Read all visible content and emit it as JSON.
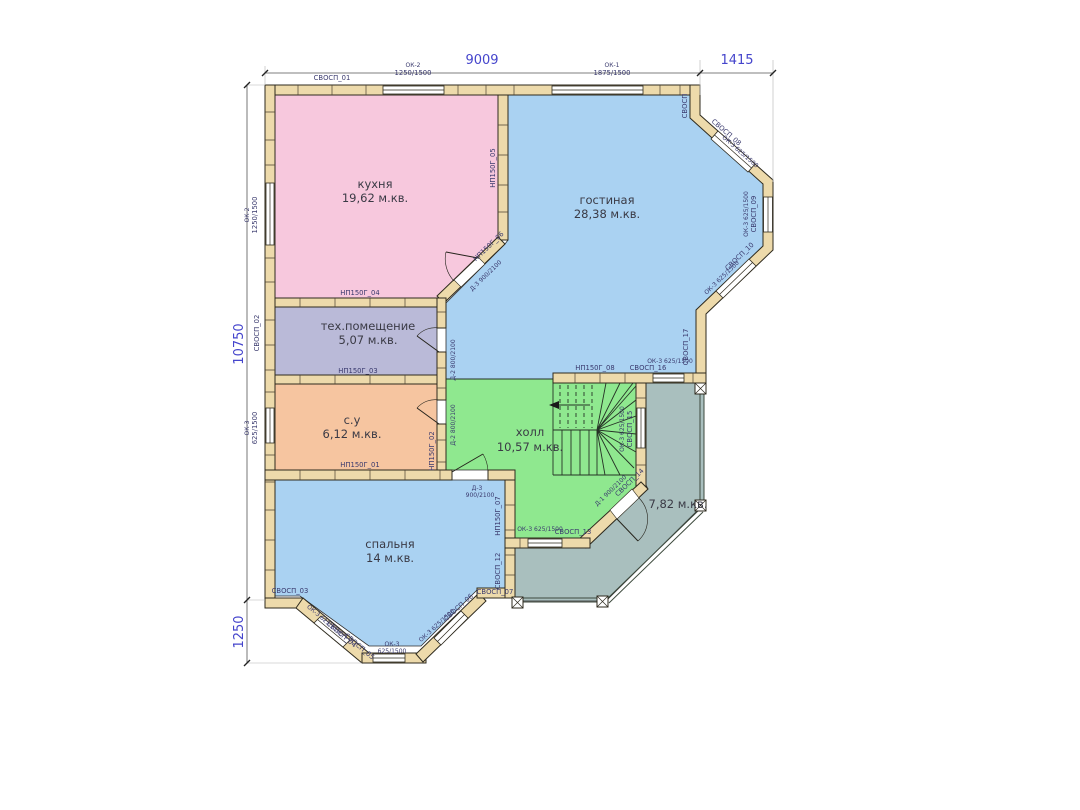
{
  "title": "План 1 этажа",
  "dimensions": {
    "top": "9009",
    "top_right": "1415",
    "left": "10750",
    "bottom_left": "1250"
  },
  "rooms": {
    "kitchen": {
      "name": "кухня",
      "area": "19,62 м.кв."
    },
    "living": {
      "name": "гостиная",
      "area": "28,38 м.кв."
    },
    "tech": {
      "name": "тех.помещение",
      "area": "5,07 м.кв."
    },
    "wc": {
      "name": "с.у",
      "area": "6,12 м.кв."
    },
    "hall": {
      "name": "холл",
      "area": "10,57 м.кв."
    },
    "bedroom": {
      "name": "спальня",
      "area": "14 м.кв."
    },
    "terrace": {
      "area": "7,82 м.кв."
    }
  },
  "panels": {
    "svosp01": "СВОСП_01",
    "svosp02": "СВОСП_02",
    "svosp03": "СВОСП_03",
    "svosp04": "СВОСП_04",
    "svosp05": "СВОСП_05",
    "svosp06": "СВОСП_06",
    "svosp07": "СВОСП_07",
    "svosp08": "СВОСП_08",
    "svosp09": "СВОСП_09",
    "svosp10": "СВОСП_10",
    "svosp12": "СВОСП_12",
    "svosp13": "СВОСП_13",
    "svosp14": "СВОСП_14",
    "svosp15": "СВОСП_15",
    "svosp16": "СВОСП_16",
    "svosp17": "СВОСП_17",
    "svosp_corner": "СВОСП"
  },
  "partitions": {
    "np01": "НП150Г_01",
    "np02": "НП150Г_02",
    "np03": "НП150Г_03",
    "np04": "НП150Г_04",
    "np05": "НП150Г_05",
    "np06": "НП150Г_06",
    "np07": "НП150Г_07",
    "np08": "НП150Г_08"
  },
  "windows": {
    "ok1": {
      "label": "ОК-1",
      "size": "1875/1500"
    },
    "ok2": {
      "label": "ОК-2",
      "size": "1250/1500"
    },
    "ok3": {
      "label": "ОК-3",
      "size": "625/1500"
    }
  },
  "doors": {
    "d1": {
      "label": "Д-1",
      "size": "900/2100"
    },
    "d2": {
      "label": "Д-2",
      "size": "800/2100"
    },
    "d3": {
      "label": "Д-3",
      "size": "900/2100"
    }
  },
  "colors": {
    "kitchen": "#f7c8dd",
    "living": "#aad2f2",
    "bedroom": "#aad2f2",
    "tech": "#babad8",
    "wc": "#f6c5a0",
    "hall": "#8fe88f",
    "terrace": "#a9bfbe",
    "wall_wood": "#eddaab",
    "outline": "#2e2a1e",
    "dimension_text": "#4545cc",
    "label_text": "#3a3a6e",
    "room_text": "#3a3a45"
  }
}
